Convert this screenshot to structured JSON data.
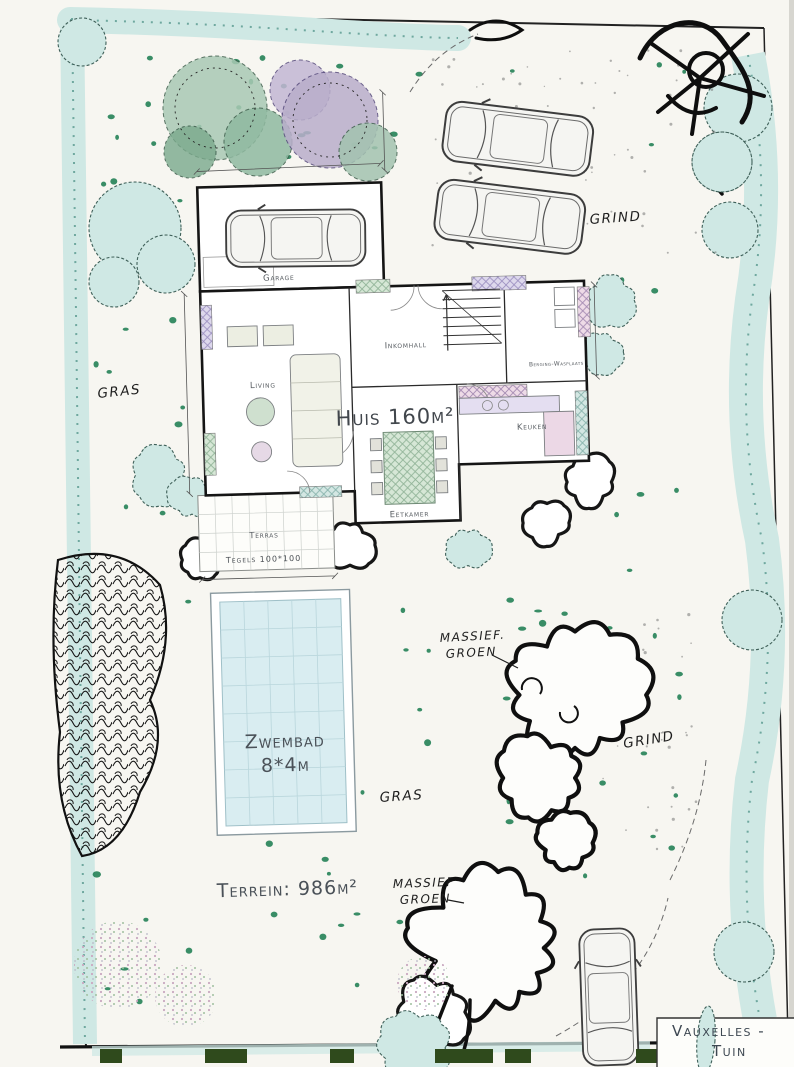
{
  "colors": {
    "paper": "#f7f6f1",
    "hedge": "#cfe8e4",
    "hedge_dark": "#6fa89f",
    "pool": "#d9edf1",
    "accent": "#177a4e",
    "ink": "#1a1a1a",
    "hedge_block": "#2f4a1c"
  },
  "title_block": {
    "line1": "Vauxelles -",
    "line2": "Tuin",
    "date": "17 juni 2009"
  },
  "area_labels": {
    "huis": "Huis 160m²",
    "zwembad_line1": "Zwembad",
    "zwembad_line2": "8*4m",
    "terrein": "Terrein: 986m²"
  },
  "hand_labels": {
    "gras_left": "GRAS",
    "gras_center": "GRAS",
    "grind_top": "GRIND",
    "grind_right": "GRIND",
    "massief_top_1": "MASSIEF.",
    "massief_top_2": "GROEN",
    "massief_bottom_1": "MASSIEF",
    "massief_bottom_2": "GROEN"
  },
  "rooms": {
    "garage": "Garage",
    "living": "Living",
    "inkomhall": "Inkomhall",
    "berging_wasplaats": "Berging-Wasplaats",
    "keuken": "Keuken",
    "eetkamer": "Eetkamer",
    "terras": "Terras",
    "tegels": "Tegels 100*100"
  }
}
